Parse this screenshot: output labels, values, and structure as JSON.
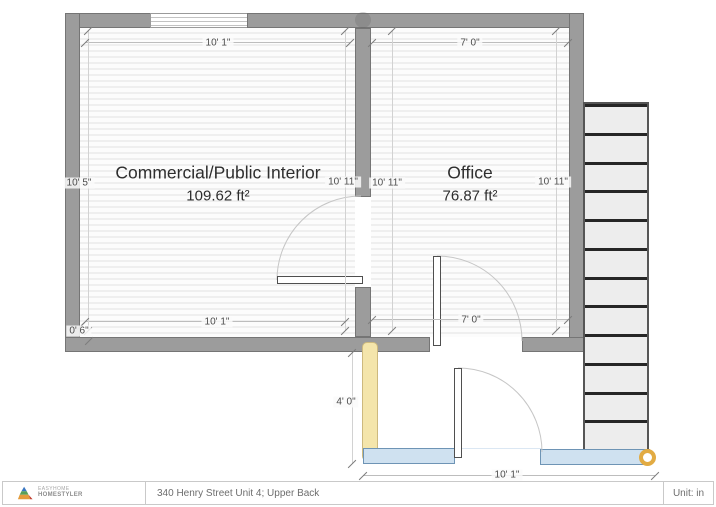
{
  "plan": {
    "rooms": [
      {
        "name": "Commercial/Public Interior",
        "area": "109.62 ft²",
        "dim_top": "10' 1\"",
        "dim_bottom": "10' 1\"",
        "dim_left": "10' 5\"",
        "dim_right": "10' 11\""
      },
      {
        "name": "Office",
        "area": "76.87 ft²",
        "dim_top": "7' 0\"",
        "dim_bottom": "7' 0\"",
        "dim_left": "10' 11\"",
        "dim_right": "10' 11\""
      }
    ],
    "wall_thickness_label": "0' 6\"",
    "exterior": {
      "height_label": "4' 0\"",
      "width_label": "10' 1\""
    },
    "stairs": {
      "steps": 12
    },
    "colors": {
      "wall": "#9c9c9c",
      "highlighted_wall": "#f4e5ab",
      "threshold": "#cfe1f0",
      "endpoint_marker": "#e2ab43"
    }
  },
  "footer": {
    "brand_top": "EASYHOME",
    "brand_bottom": "HOMESTYLER",
    "address": "340 Henry Street Unit 4; Upper Back",
    "unit": "Unit: in"
  }
}
